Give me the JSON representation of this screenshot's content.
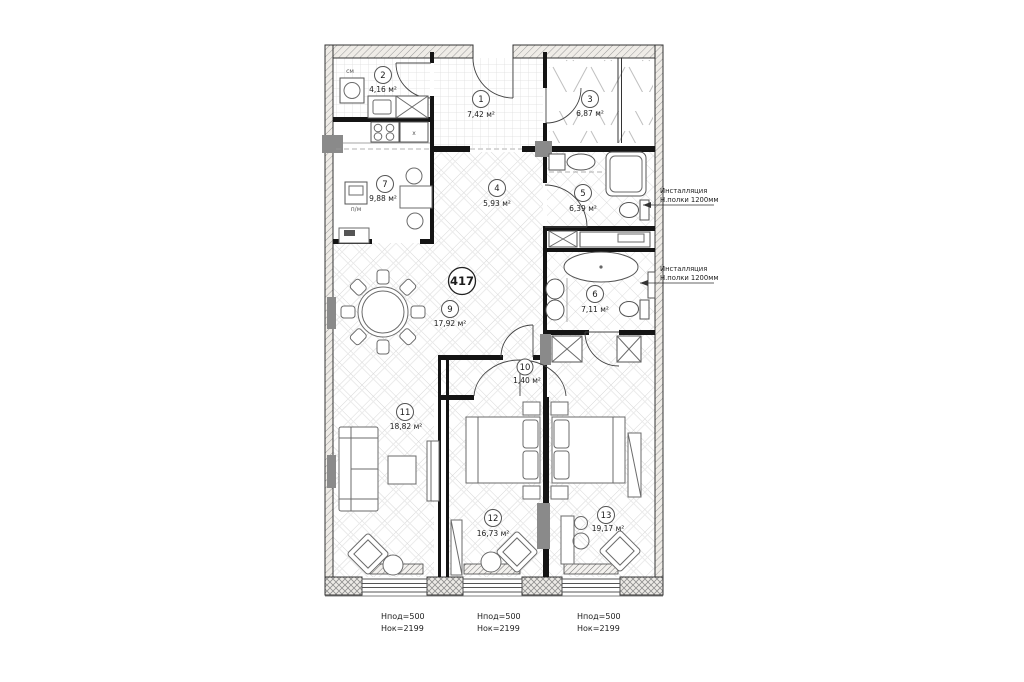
{
  "plan": {
    "apartment_number": "417",
    "rooms": [
      {
        "number": "1",
        "area": "7,42 м²"
      },
      {
        "number": "2",
        "area": "4,16 м²"
      },
      {
        "number": "3",
        "area": "6,87 м²"
      },
      {
        "number": "4",
        "area": "5,93 м²"
      },
      {
        "number": "5",
        "area": "6,39 м²"
      },
      {
        "number": "6",
        "area": "7,11 м²"
      },
      {
        "number": "7",
        "area": "9,88 м²"
      },
      {
        "number": "9",
        "area": "17,92 м²"
      },
      {
        "number": "10",
        "area": "1,40 м²"
      },
      {
        "number": "11",
        "area": "18,82 м²"
      },
      {
        "number": "12",
        "area": "16,73 м²"
      },
      {
        "number": "13",
        "area": "19,17 м²"
      }
    ],
    "appliance_labels": {
      "washing_machine": "см",
      "dishwasher": "п/м",
      "cabinet": "x"
    },
    "annotations": [
      {
        "line1": "Инсталляция",
        "line2": "Н.полки 1200мм"
      },
      {
        "line1": "Инсталляция",
        "line2": "Н.полки 1200мм"
      }
    ],
    "window_labels": [
      {
        "line1": "Нпод=500",
        "line2": "Нок=2199"
      },
      {
        "line1": "Нпод=500",
        "line2": "Нок=2199"
      },
      {
        "line1": "Нпод=500",
        "line2": "Нок=2199"
      }
    ]
  }
}
